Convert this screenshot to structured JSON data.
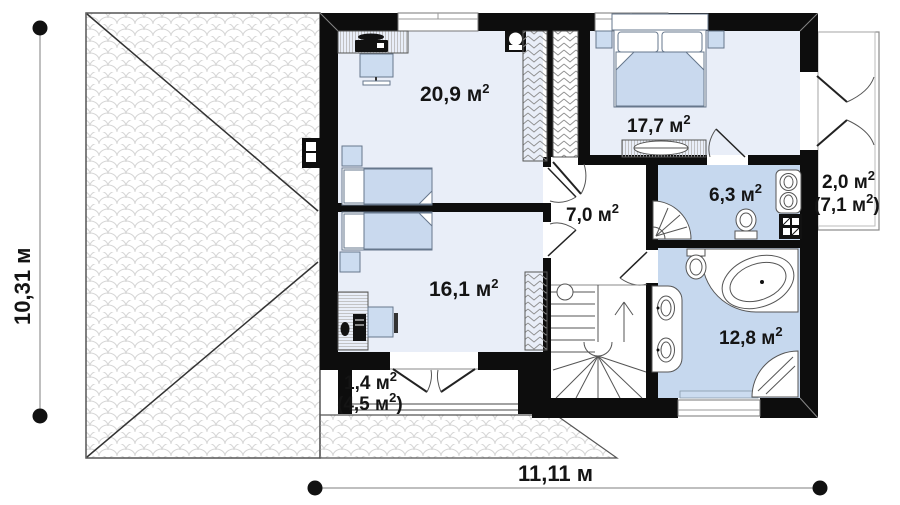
{
  "plan": {
    "type": "floor-plan",
    "rooms": {
      "bedroom_top_left": {
        "label": "20,9 м",
        "sup": "2"
      },
      "bedroom_top_right": {
        "label": "17,7 м",
        "sup": "2"
      },
      "hall": {
        "label": "7,0 м",
        "sup": "2"
      },
      "bathroom_small": {
        "label": "6,3 м",
        "sup": "2"
      },
      "bedroom_bottom_left": {
        "label": "16,1 м",
        "sup": "2"
      },
      "bathroom_large": {
        "label": "12,8 м",
        "sup": "2"
      },
      "balcony_right": {
        "line1": "2,0 м",
        "line1_sup": "2",
        "line2": "(7,1 м",
        "line2_sup": "2",
        "line2_close": ")"
      },
      "balcony_bottom": {
        "line1": "1,4 м",
        "line1_sup": "2",
        "line2": "(4,5 м",
        "line2_sup": "2",
        "line2_close": ")"
      }
    },
    "dimensions": {
      "height": "10,31 м",
      "width": "11,11 м"
    },
    "colors": {
      "wall": "#0d0d0d",
      "room_light": "#e9eef8",
      "room_blue": "#c6d8ee",
      "furniture_blue": "#ccdcf0",
      "roof_line": "#d6d6d6"
    }
  }
}
